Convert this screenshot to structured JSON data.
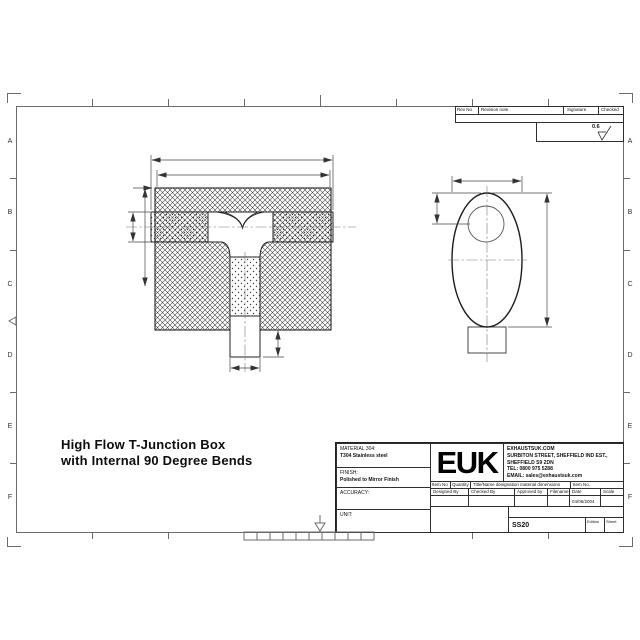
{
  "colors": {
    "paper": "#ffffff",
    "line": "#2f2f2f",
    "frame": "#6b6b6b"
  },
  "sheet": {
    "zone_letters": [
      "A",
      "B",
      "C",
      "D",
      "E",
      "F"
    ],
    "surface_finish_value": "0.6"
  },
  "revision_table": {
    "headers": [
      "Rev No",
      "Revision note",
      "Signature",
      "Checked"
    ]
  },
  "drawing_title": {
    "line1": "High Flow T-Junction Box",
    "line2": "with Internal 90 Degree Bends"
  },
  "title_block": {
    "material_label": "MATERIAL 304:",
    "material_value": "T304 Stainless steel",
    "finish_label": "FINISH:",
    "finish_value": "Polished to Mirror Finish",
    "accuracy_label": "ACCURACY:",
    "unit_label": "UNIT:",
    "logo": "EUK",
    "address": [
      "EXHAUSTSUK.COM",
      "SURBITON STREET, SHEFFIELD IND EST.,",
      "SHEFFIELD S9 2DN",
      "TEL: 0800 975 5288",
      "EMAIL: sales@exhaustsuk.com"
    ],
    "item_row": [
      "Item No",
      "Quantity",
      "Title/Name designation material dimensions",
      "Item No."
    ],
    "approval_row": [
      "Designed By",
      "Checked By",
      "Approved by date",
      "Filename",
      "Date",
      "Scale"
    ],
    "date_value": "04/06/2004",
    "drawing_number": "SS20",
    "edition_label": "Edition",
    "sheet_label": "Sheet"
  }
}
